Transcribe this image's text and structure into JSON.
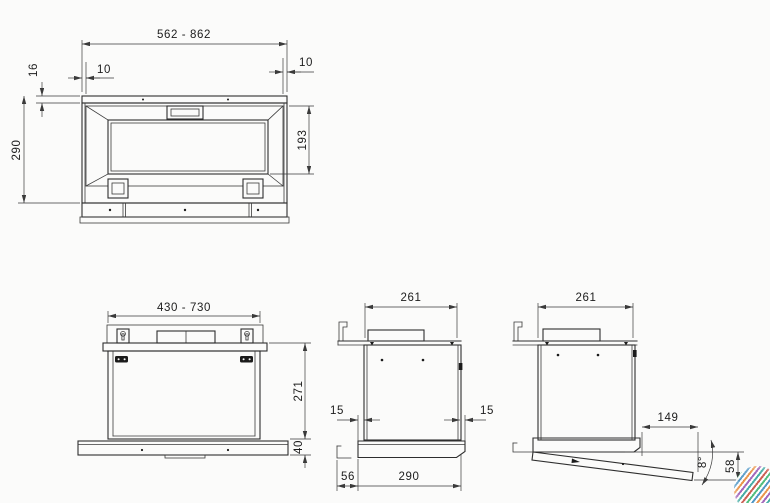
{
  "drawing": {
    "kind": "built-in cooker hood installation drawing",
    "line_color": "#2e2e2e",
    "background": "#fbfbfa"
  },
  "top_view": {
    "label_width_range": "562 - 862",
    "label_inset_left": "10",
    "label_inset_right": "10",
    "label_rail_depth": "16",
    "label_total_depth": "290",
    "label_opening_depth": "193"
  },
  "front_view": {
    "label_width_range": "430 - 730",
    "label_body_height": "271",
    "label_visor_height": "40"
  },
  "side_view": {
    "label_top_depth": "261",
    "label_gap_left": "15",
    "label_gap_right": "15",
    "label_wall_gap": "56",
    "label_body_depth": "290"
  },
  "open_view": {
    "label_top_depth": "261",
    "label_panel_length": "149",
    "label_tilt_angle": "8°",
    "label_drop_height": "58"
  },
  "logo": {
    "name": "multicolour thread-ball logo"
  }
}
